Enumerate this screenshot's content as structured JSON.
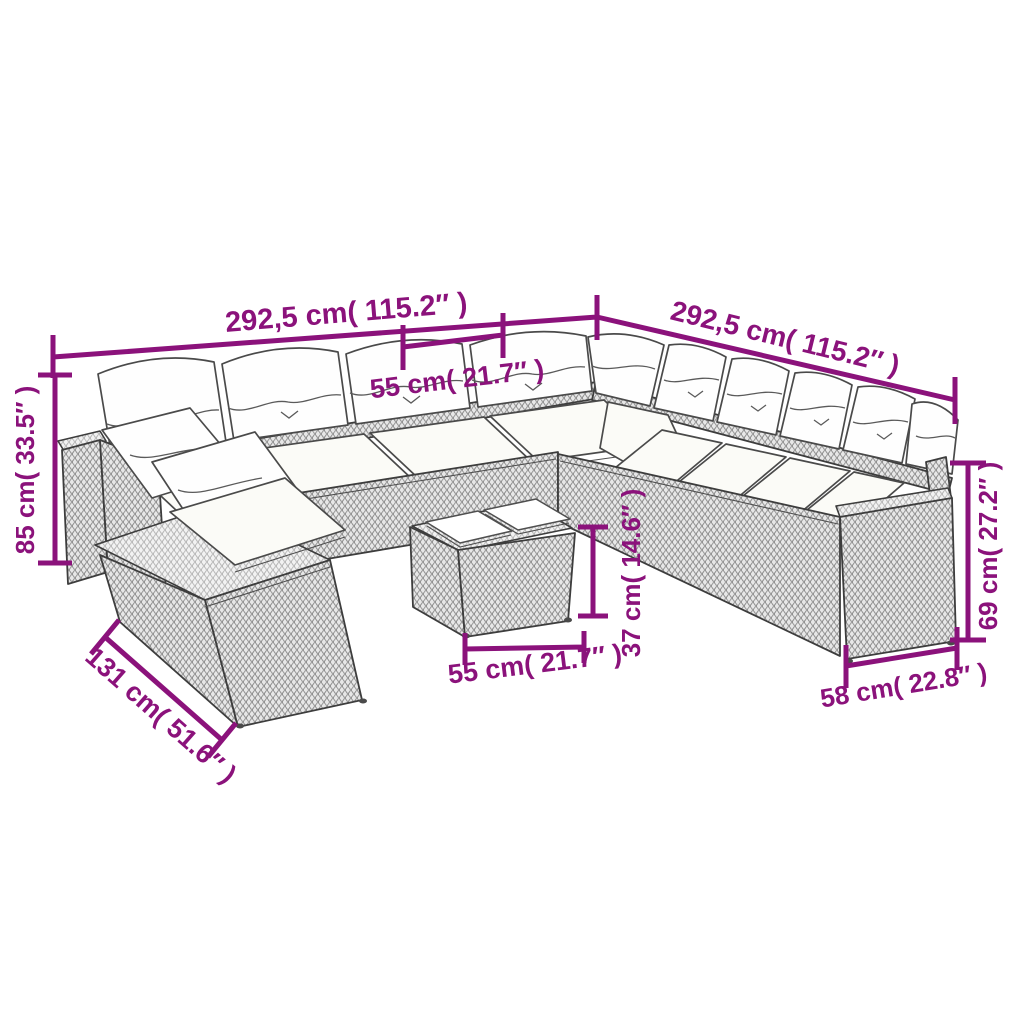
{
  "page": {
    "background": "#ffffff",
    "description": "Line-art dimension diagram of a poly rattan garden lounge set: U-shaped modular sofa with white cushions, corner chaise module and a two-tray coffee table, annotated with purple measurements."
  },
  "style": {
    "dimension_color": "#8B127B",
    "outline_color": "#454545",
    "cushion_color": "#ffffff",
    "rattan_tone": "#e9e9e9"
  },
  "dimensions": {
    "back_width_left": {
      "label": "292,5 cm( 115.2″ )",
      "cm": "292,5",
      "inches": "115.2"
    },
    "back_width_right": {
      "label": "292,5 cm( 115.2″ )",
      "cm": "292,5",
      "inches": "115.2"
    },
    "seat_module_width": {
      "label": "55 cm( 21.7″ )",
      "cm": "55",
      "inches": "21.7"
    },
    "overall_height": {
      "label": "85 cm( 33.5″ )",
      "cm": "85",
      "inches": "33.5"
    },
    "corner_module_depth": {
      "label": "131 cm( 51.6″ )",
      "cm": "131",
      "inches": "51.6"
    },
    "table_width": {
      "label": "55 cm( 21.7″ )",
      "cm": "55",
      "inches": "21.7"
    },
    "table_height": {
      "label": "37 cm( 14.6″ )",
      "cm": "37",
      "inches": "14.6"
    },
    "armrest_height": {
      "label": "69 cm( 27.2″ )",
      "cm": "69",
      "inches": "27.2"
    },
    "end_module_depth": {
      "label": "58 cm( 22.8″ )",
      "cm": "58",
      "inches": "22.8"
    }
  }
}
